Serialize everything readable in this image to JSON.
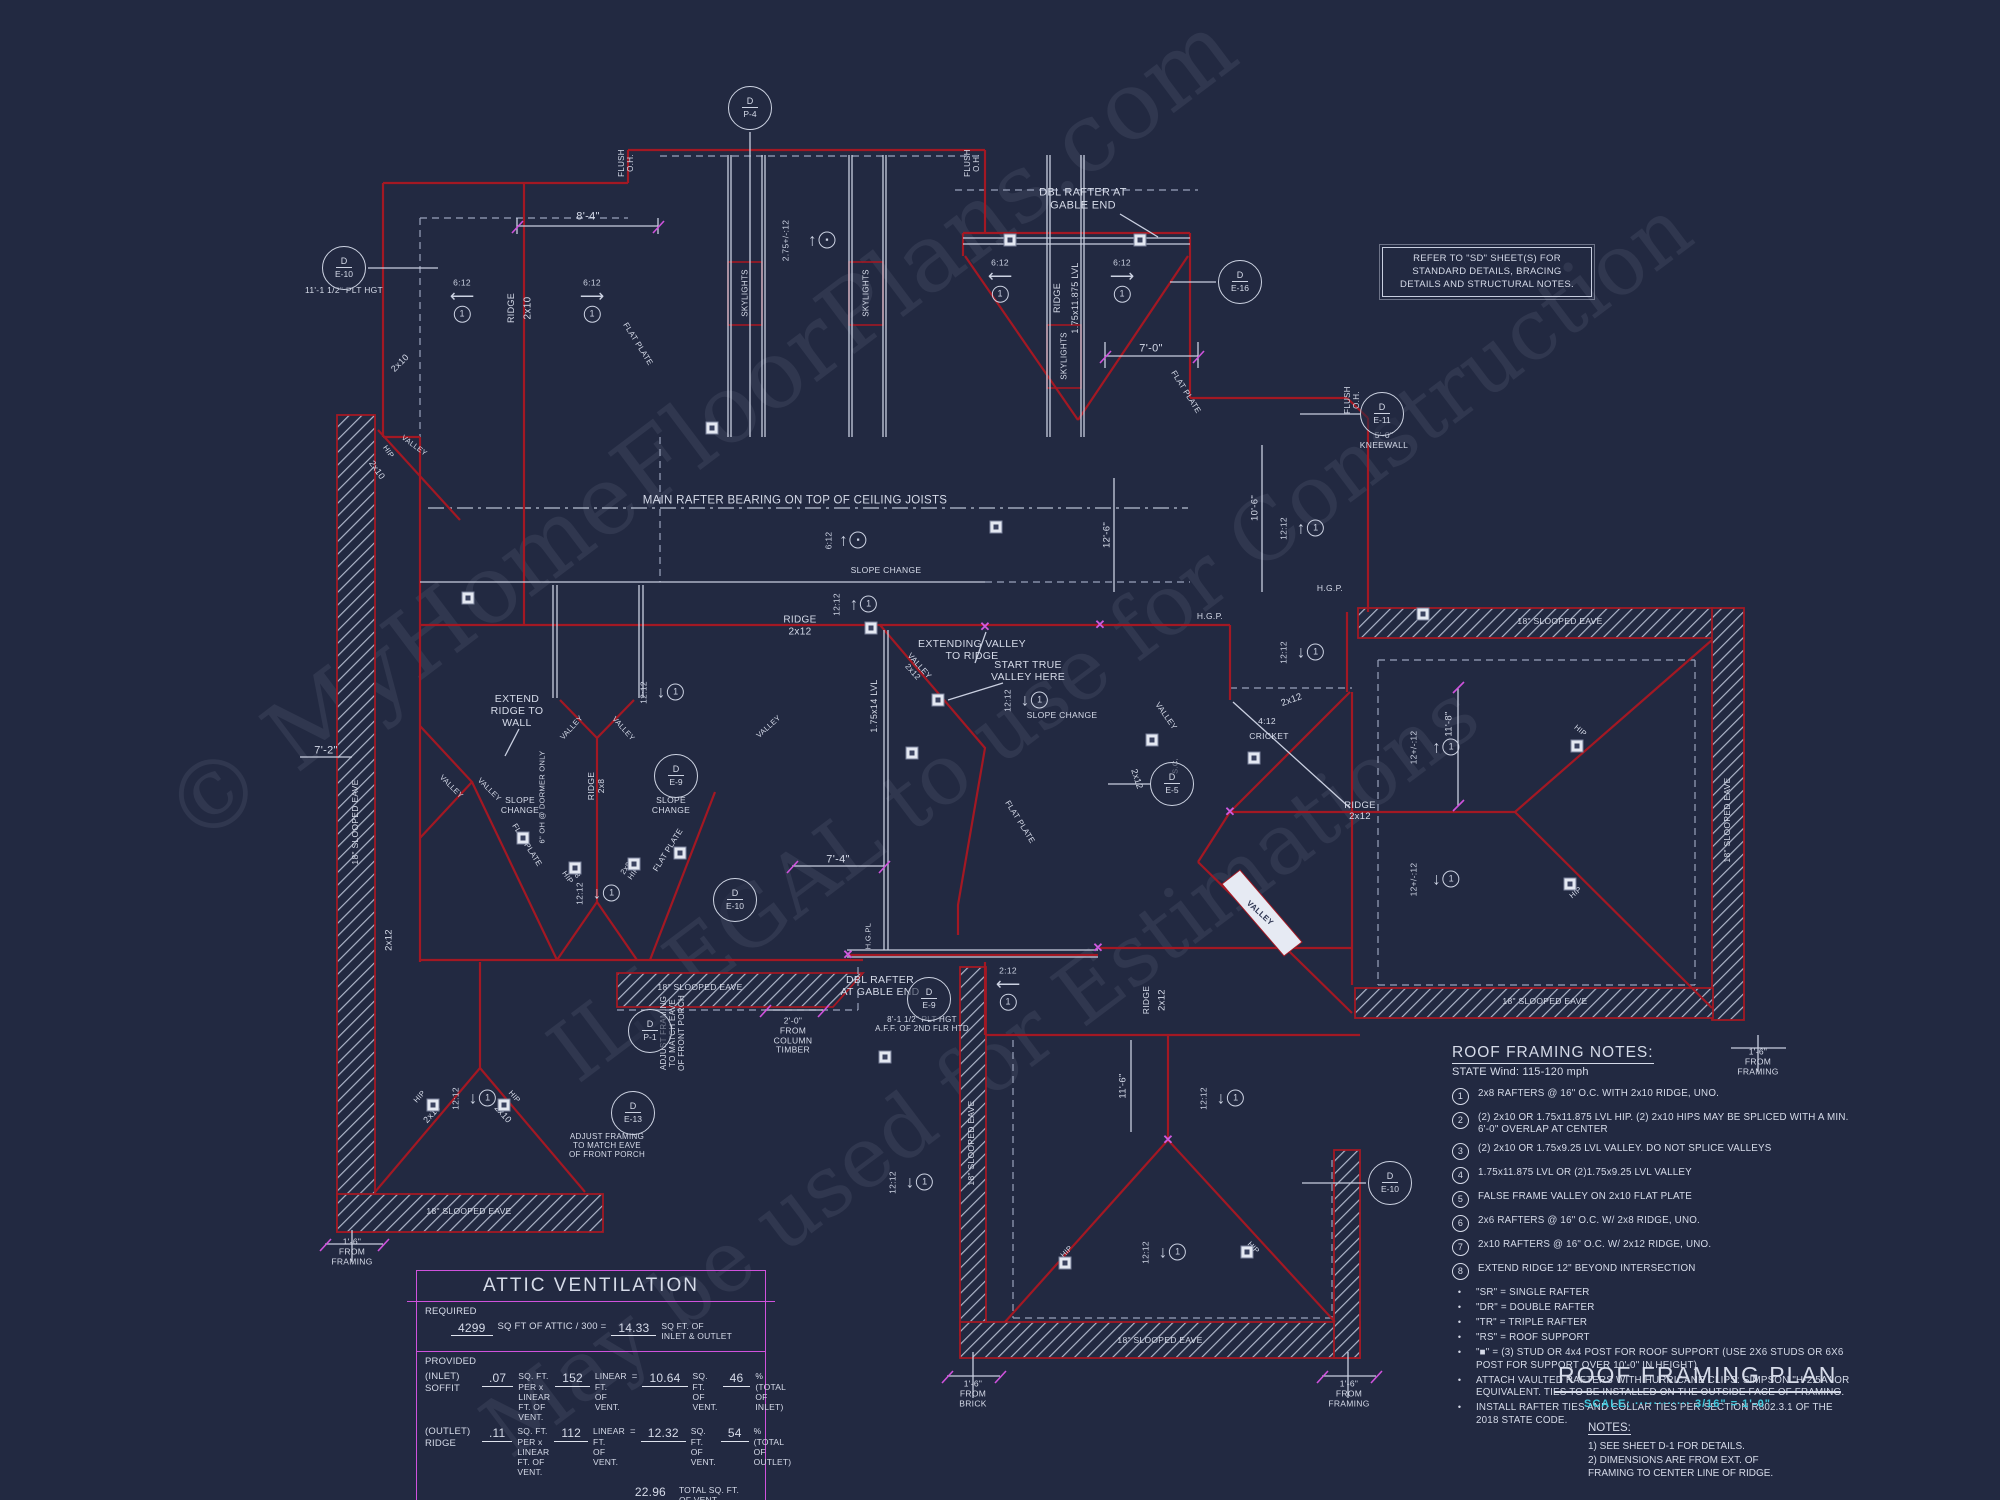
{
  "colors": {
    "bg": "#222941",
    "red": "#a31823",
    "line": "#c9cfe0",
    "dash": "#9aa3bc",
    "magenta": "#cf52dc",
    "cyan": "#3fc8dc",
    "text": "#d6dbe9"
  },
  "watermarks": [
    {
      "t": "© MyHomeFloorPlans.com",
      "x": 700,
      "y": 430,
      "s": 95
    },
    {
      "t": "ILLEGAL to use for Construction",
      "x": 1120,
      "y": 640,
      "s": 84
    },
    {
      "t": "May be used for Estimations",
      "x": 980,
      "y": 1070,
      "s": 84
    }
  ],
  "ref_note": {
    "lines": [
      "REFER TO \"SD\"  SHEET(S) FOR",
      "STANDARD DETAILS, BRACING",
      "DETAILS AND STRUCTURAL NOTES."
    ]
  },
  "roof_notes": {
    "title": "ROOF FRAMING NOTES:",
    "subtitle": "STATE Wind: 115-120 mph",
    "numbered": [
      "2x8 RAFTERS @ 16\" O.C. WITH 2x10 RIDGE, UNO.",
      "(2) 2x10 OR 1.75x11.875 LVL HIP. (2) 2x10 HIPS MAY BE SPLICED WITH A MIN. 6'-0\" OVERLAP AT CENTER",
      "(2) 2x10 OR 1.75x9.25 LVL VALLEY. DO NOT SPLICE VALLEYS",
      "1.75x11.875 LVL OR (2)1.75x9.25 LVL VALLEY",
      "FALSE FRAME VALLEY ON 2x10 FLAT PLATE",
      "2x6 RAFTERS @ 16\" O.C. W/ 2x8 RIDGE, UNO.",
      "2x10 RAFTERS @ 16\" O.C. W/ 2x12 RIDGE, UNO.",
      "EXTEND RIDGE 12\" BEYOND INTERSECTION"
    ],
    "bullets": [
      "\"SR\"  = SINGLE RAFTER",
      "\"DR\" = DOUBLE RAFTER",
      "\"TR\" = TRIPLE RAFTER",
      "\"RS\" = ROOF SUPPORT",
      "\"■\" = (3) STUD OR 4x4 POST FOR ROOF SUPPORT (USE 2X6 STUDS OR 6X6 POST FOR SUPPORT OVER 10'-0\" IN HEIGHT)",
      "ATTACH VAULTED RAFTERS WITH HURRICANE CLIPS: SIMPSON \"H-2.5A\" OR EQUIVALENT. TIES TO BE INSTALLED ON THE OUTSIDE FACE OF FRAMING.",
      "INSTALL RAFTER TIES AND COLLAR TIES PER SECTION R802.3.1 OF THE 2018 STATE CODE."
    ]
  },
  "title_block": {
    "title": "ROOF FRAMING PLAN",
    "scale": "SCALE:  ············  3/16\" = 1'-0\"",
    "notes_title": "NOTES:",
    "notes": [
      "1)  SEE SHEET D-1 FOR DETAILS.",
      "2)  DIMENSIONS ARE FROM EXT. OF\n      FRAMING TO CENTER LINE OF RIDGE."
    ]
  },
  "attic": {
    "title": "ATTIC VENTILATION",
    "required_label": "REQUIRED",
    "req_value": "4299",
    "req_mid": "SQ FT OF ATTIC / 300 =",
    "req_result": "14.33",
    "req_unit": "SQ FT. OF\nINLET & OUTLET",
    "provided_label": "PROVIDED",
    "rows": [
      {
        "cat": "(INLET)\nSOFFIT",
        "rate": ".07",
        "rate_u": "SQ. FT. PER x\nLINEAR FT. OF VENT.",
        "len": "152",
        "len_u": "LINEAR FT.\nOF VENT.",
        "res": "10.64",
        "res_u": "SQ. FT.\nOF VENT.",
        "pct": "46",
        "pct_u": "%\n(TOTAL OF\nINLET)"
      },
      {
        "cat": "(OUTLET)\nRIDGE",
        "rate": ".11",
        "rate_u": "SQ. FT. PER x\nLINEAR FT. OF VENT.",
        "len": "112",
        "len_u": "LINEAR FT.\nOF VENT.",
        "res": "12.32",
        "res_u": "SQ. FT.\nOF VENT.",
        "pct": "54",
        "pct_u": "%\n(TOTAL OF\nOUTLET)"
      }
    ],
    "total_value": "22.96",
    "total_label": "TOTAL  SQ. FT.\nOF VENT."
  },
  "plan": {
    "labels": [
      {
        "t": "8'-4\"",
        "x": 588,
        "y": 217,
        "s": 11
      },
      {
        "t": "RIDGE",
        "x": 511,
        "y": 308,
        "r": -90,
        "s": 9
      },
      {
        "t": "2x10",
        "x": 528,
        "y": 308,
        "r": -90,
        "s": 10
      },
      {
        "t": "FLUSH\nO.H.",
        "x": 626,
        "y": 163,
        "r": -90,
        "s": 8
      },
      {
        "t": "FLUSH\nO.H.",
        "x": 972,
        "y": 163,
        "r": -90,
        "s": 8
      },
      {
        "t": "FLUSH\nO.H.",
        "x": 1352,
        "y": 400,
        "r": -90,
        "s": 8
      },
      {
        "t": "SKYLIGHTS",
        "x": 745,
        "y": 293,
        "r": -90,
        "s": 8
      },
      {
        "t": "SKYLIGHTS",
        "x": 866,
        "y": 293,
        "r": -90,
        "s": 8
      },
      {
        "t": "SKYLIGHTS",
        "x": 1064,
        "y": 356,
        "r": -90,
        "s": 8
      },
      {
        "t": "DBL RAFTER AT\nGABLE END",
        "x": 1083,
        "y": 199,
        "s": 11
      },
      {
        "t": "RIDGE",
        "x": 1057,
        "y": 298,
        "r": -90,
        "s": 9
      },
      {
        "t": "1.75x11.875 LVL",
        "x": 1075,
        "y": 298,
        "r": -90,
        "s": 9
      },
      {
        "t": "7'-0\"",
        "x": 1151,
        "y": 349,
        "s": 11
      },
      {
        "t": "FLAT PLATE",
        "x": 1186,
        "y": 392,
        "r": 58,
        "s": 8
      },
      {
        "t": "FLAT PLATE",
        "x": 638,
        "y": 344,
        "r": 58,
        "s": 8
      },
      {
        "t": "FLAT PLATE",
        "x": 527,
        "y": 845,
        "r": 58,
        "s": 8
      },
      {
        "t": "FLAT PLATE",
        "x": 668,
        "y": 850,
        "r": -58,
        "s": 8
      },
      {
        "t": "FLAT PLATE",
        "x": 1020,
        "y": 822,
        "r": 58,
        "s": 8
      },
      {
        "t": "11'-1 1/2\" PLT HGT",
        "x": 344,
        "y": 291,
        "s": 8.5
      },
      {
        "t": "MAIN RAFTER BEARING ON TOP OF CEILING JOISTS",
        "x": 795,
        "y": 501,
        "s": 11.5
      },
      {
        "t": "SLOPE CHANGE",
        "x": 886,
        "y": 571,
        "s": 8.5
      },
      {
        "t": "SLOPE CHANGE",
        "x": 1062,
        "y": 716,
        "s": 8.5
      },
      {
        "t": "SLOPE\nCHANGE",
        "x": 520,
        "y": 806,
        "s": 8.5
      },
      {
        "t": "SLOPE\nCHANGE",
        "x": 671,
        "y": 806,
        "s": 8.5
      },
      {
        "t": "RIDGE\n2x12",
        "x": 800,
        "y": 626,
        "s": 10
      },
      {
        "t": "EXTENDING VALLEY\nTO RIDGE",
        "x": 972,
        "y": 650,
        "s": 10.5
      },
      {
        "t": "START TRUE\nVALLEY HERE",
        "x": 1028,
        "y": 671,
        "s": 10.5
      },
      {
        "t": "VALLEY\n2x12",
        "x": 916,
        "y": 669,
        "r": 48,
        "s": 8
      },
      {
        "t": "1.75x14 LVL",
        "x": 874,
        "y": 706,
        "r": -90,
        "s": 9
      },
      {
        "t": "VALLEY",
        "x": 1166,
        "y": 716,
        "r": 55,
        "s": 8
      },
      {
        "t": "2x12",
        "x": 1137,
        "y": 779,
        "r": 72,
        "s": 9
      },
      {
        "t": "S.C.",
        "x": 1176,
        "y": 766,
        "r": -90,
        "s": 7.5
      },
      {
        "t": "EXTEND\nRIDGE TO\nWALL",
        "x": 517,
        "y": 711,
        "s": 10.5
      },
      {
        "t": "VALLEY",
        "x": 451,
        "y": 787,
        "r": 45,
        "s": 7.5
      },
      {
        "t": "VALLEY",
        "x": 489,
        "y": 790,
        "r": 45,
        "s": 7.5
      },
      {
        "t": "VALLEY",
        "x": 572,
        "y": 728,
        "r": -48,
        "s": 7.5
      },
      {
        "t": "VALLEY",
        "x": 623,
        "y": 729,
        "r": 48,
        "s": 7.5
      },
      {
        "t": "VALLEY",
        "x": 769,
        "y": 727,
        "r": -42,
        "s": 7.5
      },
      {
        "t": "VALLEY",
        "x": 414,
        "y": 446,
        "r": 36,
        "s": 7.5
      },
      {
        "t": "HIP",
        "x": 388,
        "y": 452,
        "r": 55,
        "s": 7.5
      },
      {
        "t": "2x10",
        "x": 377,
        "y": 470,
        "r": 55,
        "s": 9
      },
      {
        "t": "2x10",
        "x": 400,
        "y": 363,
        "r": -45,
        "s": 9
      },
      {
        "t": "RIDGE\n2x8",
        "x": 597,
        "y": 786,
        "r": -90,
        "s": 8.5
      },
      {
        "t": "6\" OH @ DORMER ONLY",
        "x": 543,
        "y": 797,
        "r": -90,
        "s": 7.5
      },
      {
        "t": "2x8\nHIP",
        "x": 571,
        "y": 875,
        "r": 55,
        "s": 7.5
      },
      {
        "t": "2x8\nHIP",
        "x": 630,
        "y": 871,
        "r": -55,
        "s": 7.5
      },
      {
        "t": "7'-4\"",
        "x": 838,
        "y": 860,
        "s": 11
      },
      {
        "t": "7'-2\"",
        "x": 326,
        "y": 751,
        "s": 11
      },
      {
        "t": "18\" SLOOPED EAVE",
        "x": 700,
        "y": 988,
        "s": 8.5
      },
      {
        "t": "18\" SLOOPED EAVE",
        "x": 469,
        "y": 1212,
        "s": 8.5
      },
      {
        "t": "18\" SLOOPED EAVE",
        "x": 356,
        "y": 822,
        "r": -90,
        "s": 8.5
      },
      {
        "t": "18\" SLOOPED EAVE",
        "x": 972,
        "y": 1143,
        "r": -90,
        "s": 8.5
      },
      {
        "t": "18\" SLOOPED EAVE",
        "x": 1160,
        "y": 1341,
        "s": 8.5
      },
      {
        "t": "18\" SLOOPED EAVE",
        "x": 1560,
        "y": 622,
        "s": 8.5
      },
      {
        "t": "18\" SLOOPED EAVE",
        "x": 1728,
        "y": 820,
        "r": -90,
        "s": 8.5
      },
      {
        "t": "18\" SLOOPED EAVE",
        "x": 1545,
        "y": 1002,
        "s": 8.5
      },
      {
        "t": "2'-0\"\nFROM\nCOLUMN\nTIMBER",
        "x": 793,
        "y": 1036,
        "s": 8.5
      },
      {
        "t": "DBL RAFTER\nAT GABLE END",
        "x": 880,
        "y": 986,
        "s": 10.5
      },
      {
        "t": "8'-1 1/2\" PLT HGT\nA.F.F. OF 2ND FLR HTD",
        "x": 922,
        "y": 1024,
        "s": 8
      },
      {
        "t": "H.G.PL",
        "x": 869,
        "y": 936,
        "r": -90,
        "s": 7.5
      },
      {
        "t": "H.G.P.",
        "x": 1330,
        "y": 589,
        "s": 8.5
      },
      {
        "t": "H.G.P.",
        "x": 1210,
        "y": 617,
        "s": 8.5
      },
      {
        "t": "10'-6\"",
        "x": 1256,
        "y": 508,
        "r": -90,
        "s": 9.5
      },
      {
        "t": "12'-6\"",
        "x": 1108,
        "y": 535,
        "r": -90,
        "s": 9.5
      },
      {
        "t": "11'-8\"",
        "x": 1450,
        "y": 724,
        "r": -90,
        "s": 9.5
      },
      {
        "t": "11'-6\"",
        "x": 1124,
        "y": 1086,
        "r": -90,
        "s": 9.5
      },
      {
        "t": "5'-0\"\nKNEEWALL",
        "x": 1384,
        "y": 441,
        "s": 8.5
      },
      {
        "t": "RIDGE\n2x12",
        "x": 1360,
        "y": 812,
        "s": 9.5
      },
      {
        "t": "RIDGE",
        "x": 1147,
        "y": 1000,
        "r": -90,
        "s": 8.5
      },
      {
        "t": "2x12",
        "x": 1163,
        "y": 1000,
        "r": -90,
        "s": 9.5
      },
      {
        "t": "2x12",
        "x": 1292,
        "y": 701,
        "r": -20,
        "s": 9.5
      },
      {
        "t": "4:12",
        "x": 1267,
        "y": 722,
        "s": 8.5
      },
      {
        "t": "CRICKET",
        "x": 1269,
        "y": 737,
        "s": 8.5
      },
      {
        "t": "VALLEY",
        "x": 1260,
        "y": 913,
        "r": 42,
        "s": 8,
        "c": "d"
      },
      {
        "t": "HIP",
        "x": 1580,
        "y": 731,
        "r": 40,
        "s": 7.5
      },
      {
        "t": "HIP",
        "x": 1576,
        "y": 893,
        "r": -40,
        "s": 7.5
      },
      {
        "t": "HIP",
        "x": 1067,
        "y": 1252,
        "r": -45,
        "s": 7.5
      },
      {
        "t": "HIP",
        "x": 1253,
        "y": 1248,
        "r": 45,
        "s": 7.5
      },
      {
        "t": "HIP",
        "x": 420,
        "y": 1097,
        "r": -48,
        "s": 7.5
      },
      {
        "t": "HIP",
        "x": 514,
        "y": 1097,
        "r": 48,
        "s": 7.5
      },
      {
        "t": "2x10",
        "x": 432,
        "y": 1114,
        "r": -48,
        "s": 9
      },
      {
        "t": "2x10",
        "x": 503,
        "y": 1114,
        "r": 48,
        "s": 9
      },
      {
        "t": "1'-6\"\nFROM\nFRAMING",
        "x": 352,
        "y": 1252,
        "s": 8.5
      },
      {
        "t": "1'-6\"\nFROM\nBRICK",
        "x": 973,
        "y": 1394,
        "s": 8.5
      },
      {
        "t": "1'-6\"\nFROM\nFRAMING",
        "x": 1349,
        "y": 1394,
        "s": 8.5
      },
      {
        "t": "1'-6\"\nFROM\nFRAMING",
        "x": 1758,
        "y": 1062,
        "s": 8.5
      },
      {
        "t": "ADJUST FRAMING\nTO MATCH EAVE\nOF FRONT PORCH",
        "x": 607,
        "y": 1146,
        "s": 8
      },
      {
        "t": "ADJUST FRAMING\nTO MATCH EAVE\nOF FRONT PORCH",
        "x": 673,
        "y": 1033,
        "r": -90,
        "s": 8
      },
      {
        "t": "2x12",
        "x": 390,
        "y": 940,
        "r": -90,
        "s": 9.5
      }
    ],
    "callouts": [
      {
        "x": 344,
        "y": 268,
        "top": "D",
        "bot": "E-10"
      },
      {
        "x": 750,
        "y": 108,
        "top": "D",
        "bot": "P-4"
      },
      {
        "x": 1240,
        "y": 282,
        "top": "D",
        "bot": "E-16"
      },
      {
        "x": 1382,
        "y": 414,
        "top": "D",
        "bot": "E-11"
      },
      {
        "x": 676,
        "y": 776,
        "top": "D",
        "bot": "E-9"
      },
      {
        "x": 735,
        "y": 900,
        "top": "D",
        "bot": "E-10"
      },
      {
        "x": 633,
        "y": 1113,
        "top": "D",
        "bot": "E-13"
      },
      {
        "x": 650,
        "y": 1031,
        "top": "D",
        "bot": "P-1"
      },
      {
        "x": 929,
        "y": 999,
        "top": "D",
        "bot": "E-9"
      },
      {
        "x": 1390,
        "y": 1183,
        "top": "D",
        "bot": "E-10"
      },
      {
        "x": 1172,
        "y": 784,
        "top": "D",
        "bot": "E-5"
      }
    ],
    "slopes": [
      {
        "x": 462,
        "y": 300,
        "d": "left",
        "t": "6:12"
      },
      {
        "x": 592,
        "y": 300,
        "d": "right",
        "t": "6:12"
      },
      {
        "x": 1000,
        "y": 280,
        "d": "left",
        "t": "6:12"
      },
      {
        "x": 1122,
        "y": 280,
        "d": "right",
        "t": "6:12"
      },
      {
        "x": 843,
        "y": 540,
        "d": "up",
        "t": "6:12",
        "m": "rs"
      },
      {
        "x": 851,
        "y": 604,
        "d": "up",
        "t": "12:12"
      },
      {
        "x": 658,
        "y": 692,
        "d": "down",
        "t": "12:12"
      },
      {
        "x": 1022,
        "y": 700,
        "d": "down",
        "t": "12:12"
      },
      {
        "x": 1298,
        "y": 528,
        "d": "up",
        "t": "12:12"
      },
      {
        "x": 1298,
        "y": 652,
        "d": "down",
        "t": "12:12"
      },
      {
        "x": 1160,
        "y": 1252,
        "d": "down",
        "t": "12:12"
      },
      {
        "x": 1218,
        "y": 1098,
        "d": "down",
        "t": "12:12"
      },
      {
        "x": 907,
        "y": 1182,
        "d": "down",
        "t": "12:12"
      },
      {
        "x": 1428,
        "y": 747,
        "d": "up",
        "t": "12+/-:12"
      },
      {
        "x": 1428,
        "y": 879,
        "d": "down",
        "t": "12+/-:12"
      },
      {
        "x": 800,
        "y": 240,
        "d": "up",
        "t": "2.75+/-:12",
        "m": "rs"
      },
      {
        "x": 470,
        "y": 1098,
        "d": "down",
        "t": "12:12"
      },
      {
        "x": 1008,
        "y": 988,
        "d": "left",
        "t": "2:12"
      },
      {
        "x": 594,
        "y": 893,
        "d": "down",
        "t": "12:12"
      }
    ],
    "squares": [
      [
        712,
        428
      ],
      [
        468,
        598
      ],
      [
        938,
        700
      ],
      [
        912,
        753
      ],
      [
        1152,
        740
      ],
      [
        1254,
        758
      ],
      [
        575,
        868
      ],
      [
        634,
        864
      ],
      [
        523,
        838
      ],
      [
        680,
        853
      ],
      [
        885,
        1057
      ],
      [
        1577,
        746
      ],
      [
        1570,
        884
      ],
      [
        433,
        1105
      ],
      [
        504,
        1105
      ],
      [
        1010,
        240
      ],
      [
        1140,
        240
      ],
      [
        996,
        527
      ],
      [
        1065,
        1263
      ],
      [
        1247,
        1252
      ],
      [
        871,
        628
      ],
      [
        1423,
        614
      ]
    ],
    "xmarks": [
      [
        1230,
        812
      ],
      [
        985,
        627
      ],
      [
        1100,
        625
      ],
      [
        1168,
        1140
      ],
      [
        1098,
        948
      ],
      [
        848,
        955
      ]
    ]
  }
}
